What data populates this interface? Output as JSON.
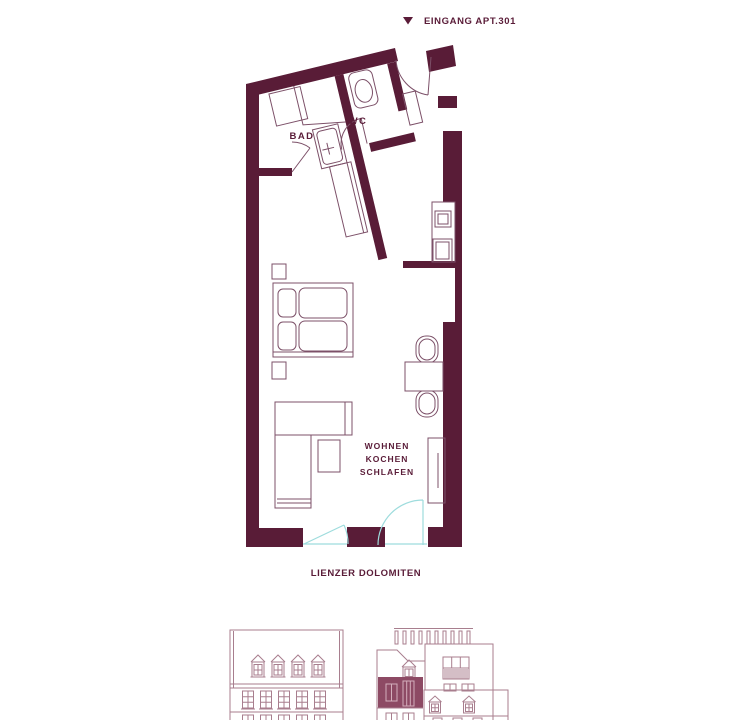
{
  "entrance_label": {
    "marker": "triangle-down",
    "text": "EINGANG APT.301"
  },
  "floorplan": {
    "rooms": [
      {
        "name": "BAD"
      },
      {
        "name": "WC"
      }
    ],
    "living_label_lines": [
      "WOHNEN",
      "KOCHEN",
      "SCHLAFEN"
    ]
  },
  "caption": {
    "text": "LIENZER DOLOMITEN"
  },
  "colors": {
    "wall": "#591c37",
    "furniture_line": "#7c5068",
    "window_swing": "#9edcdd",
    "text": "#5a1c38",
    "elevation_line": "#a87e8e",
    "elevation_highlight": "#8d4a64",
    "highlight_window_line": "#d4afbc"
  }
}
